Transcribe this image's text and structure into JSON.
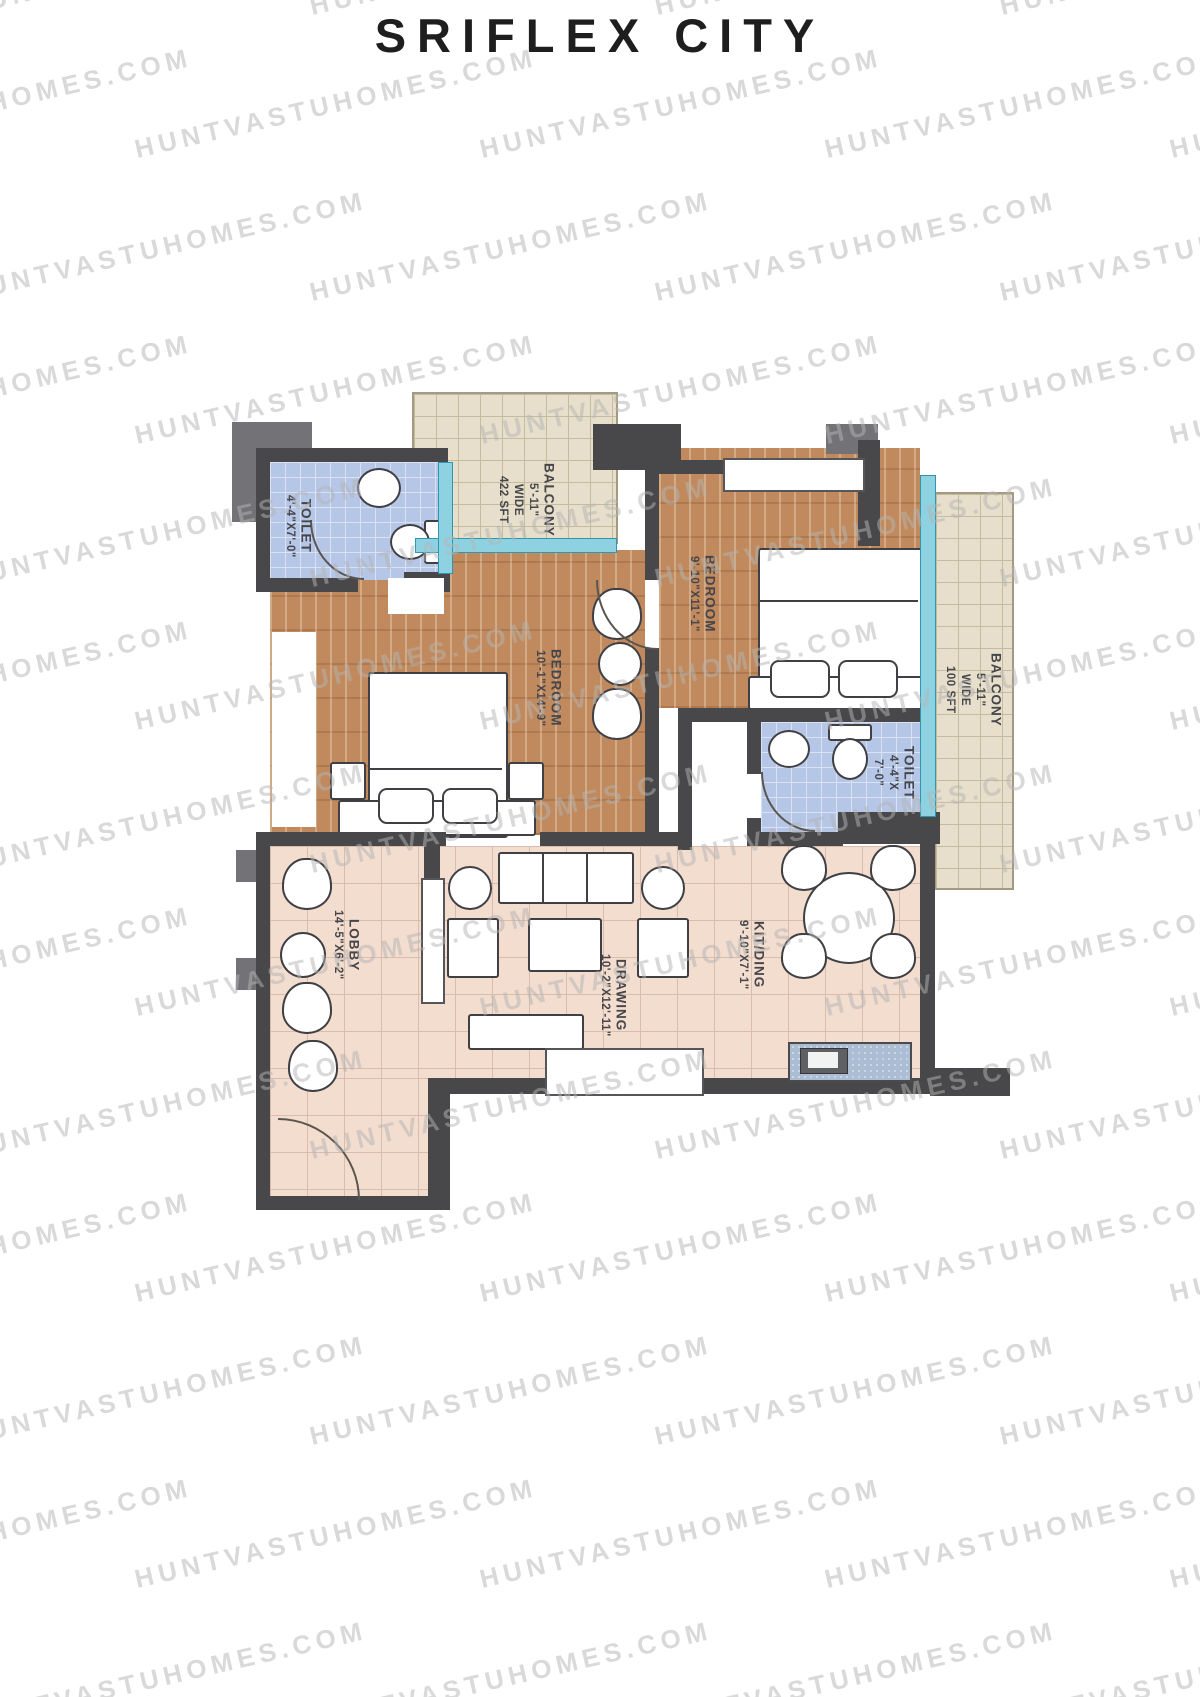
{
  "page": {
    "title": "SRIFLEX CITY"
  },
  "watermark": {
    "text": "HUNTVASTUHOMES.COM"
  },
  "rooms": {
    "toilet_left": {
      "name": "TOILET",
      "dim": "4'-4\"X7'-0\""
    },
    "balcony_top": {
      "name": "BALCONY",
      "width_label": "5'-11\"",
      "wide_label": "WIDE",
      "area_label": "422 SFT"
    },
    "bedroom_left": {
      "name": "BEDROOM",
      "dim": "10'-1\"X14'-9\""
    },
    "bedroom_right": {
      "name": "BEDROOM",
      "dim": "9'-10\"X11'-1\""
    },
    "toilet_right": {
      "name": "TOILET",
      "dim": "4'-4\"X",
      "dim2": "7'-0\""
    },
    "balcony_right": {
      "name": "BALCONY",
      "width_label": "5'-11\"",
      "wide_label": "WIDE",
      "area_label": "100 SFT"
    },
    "lobby": {
      "name": "LOBBY",
      "dim": "14'-5\"X6'-2\""
    },
    "drawing": {
      "name": "DRAWING",
      "dim": "10'-2\"X12'-11\""
    },
    "kitchen": {
      "name": "KIT/DING",
      "dim": "9'-10\"X7'-1\""
    }
  }
}
